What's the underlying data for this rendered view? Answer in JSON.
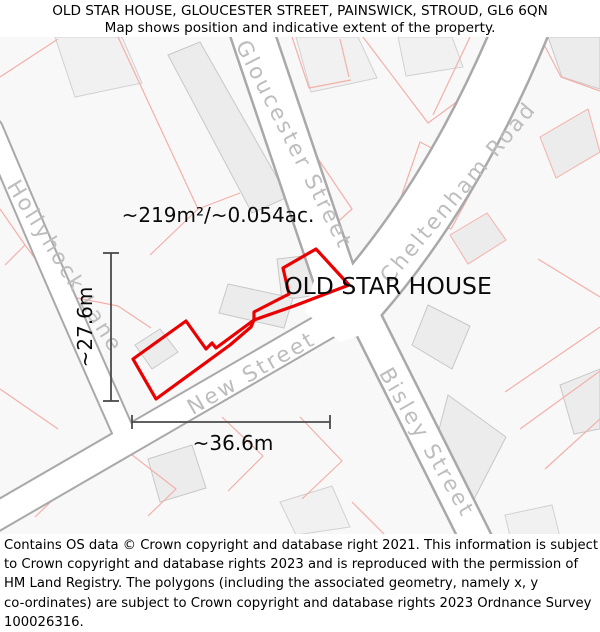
{
  "header": {
    "title": "OLD STAR HOUSE, GLOUCESTER STREET, PAINSWICK, STROUD, GL6 6QN",
    "subtitle": "Map shows position and indicative extent of the property."
  },
  "map": {
    "labels": {
      "area": "~219m²/~0.054ac.",
      "property_name": "OLD STAR HOUSE",
      "width": "~36.6m",
      "height": "~27.6m"
    },
    "street_names": {
      "gloucester": "Gloucester Street",
      "cheltenham": "Cheltenham Road",
      "hollyhock": "Hollyhock Lane",
      "new_street": "New Street",
      "bisley": "Bisley Street"
    },
    "property_outline": {
      "main_points": "316,252 349,288 294,309 254,323 254,315 289,297 283,271",
      "west_points": "254,323 216,351 212,346 206,352 186,324 133,362 156,402 230,348 251,330",
      "color": "#e90000"
    },
    "colors": {
      "property_outline": "#e90000",
      "parcel_line": "#f3b0a9",
      "street_edge": "#a8a8a8",
      "street_fill": "#ffffff",
      "building_fill": "#edecec",
      "building_edge": "#c8c8c8",
      "street_label": "#bdbdbd",
      "measurement": "#4a4a4a",
      "background": "#f9f8f8"
    }
  },
  "footer": {
    "lines": [
      "Contains OS data © Crown copyright and database right 2021. This information is subject",
      "to Crown copyright and database rights 2023 and is reproduced with the permission of",
      "HM Land Registry. The polygons (including the associated geometry, namely x, y",
      "co-ordinates) are subject to Crown copyright and database rights 2023 Ordnance Survey",
      "100026316."
    ]
  }
}
